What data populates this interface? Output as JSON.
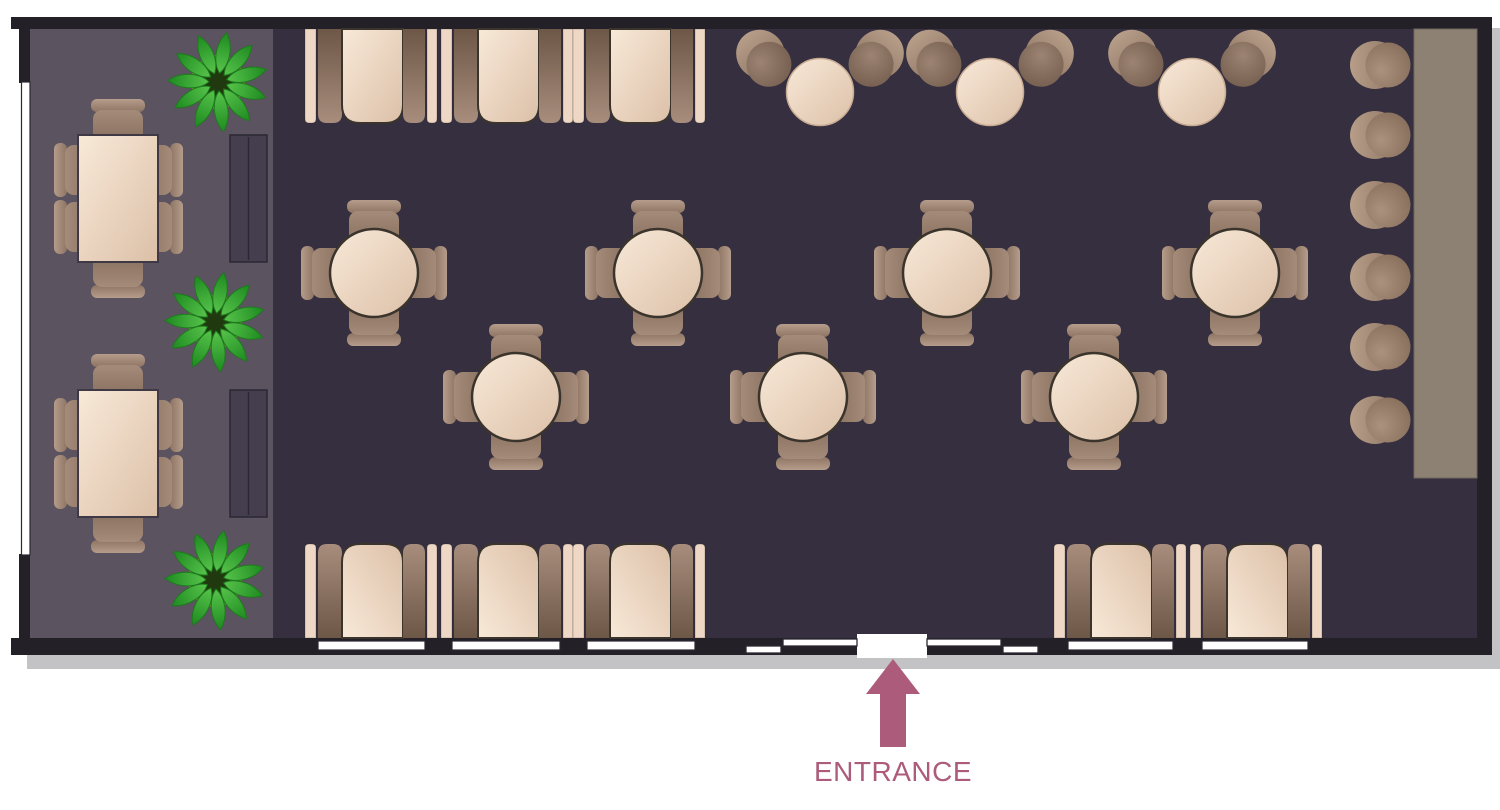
{
  "entranceText": "ENTRANCE",
  "colors": {
    "wall": "#232028",
    "shadow": "rgba(40,35,48,0.28)",
    "floor_main": "#352f3f",
    "floor_left": "#5b5360",
    "cream_1": "#f8e9d8",
    "cream_2": "#dcc0a8",
    "cream_stroke": "#3a342c",
    "rect_stroke": "#3f3945",
    "back_cream": "#eed8c5",
    "bench_1": "#a88d7c",
    "bench_2": "#6d5747",
    "chair_1": "#a58b79",
    "chair_2": "#7c6555",
    "chairback_1": "#b69d8b",
    "chairback_2": "#8d7463",
    "tub_1": "#9c8372",
    "tub_2": "#6f594a",
    "tubback_1": "#b79e89",
    "tubback_2": "#8d7462",
    "stool_1": "#ab917e",
    "stool_2": "#806955",
    "bar": "#8c8173",
    "bar_stroke": "#6f675c",
    "sofa": "#443e4e",
    "sofa_stroke": "#2b2733",
    "leaf_1": "#58c44c",
    "leaf_2": "#1e8a20",
    "leaf_edge": "#1d7a1d",
    "pot_ring": "#8e9027",
    "pot_inner": "#20390f",
    "window_fill": "#ffffff",
    "win_stroke": "#2c2832",
    "entrance": "#ad5b7a"
  },
  "floor_plan": {
    "canvas": {
      "width": 1500,
      "height": 810
    },
    "shadow": [
      21,
      22,
      1477,
      641
    ],
    "walls": [
      [
        11,
        17,
        1481,
        12
      ],
      [
        19,
        17,
        14,
        66
      ],
      [
        19,
        554,
        14,
        101
      ],
      [
        1477,
        17,
        15,
        638
      ],
      [
        11,
        638,
        1481,
        17
      ]
    ],
    "floors": {
      "main": [
        30,
        29,
        1447,
        609
      ],
      "left": [
        30,
        29,
        243,
        609
      ]
    },
    "left_window": [
      21.5,
      82,
      8.5,
      473
    ],
    "bottom_windows": [
      [
        318,
        425
      ],
      [
        452,
        560
      ],
      [
        587,
        695
      ],
      [
        1068,
        1173
      ],
      [
        1202,
        1308
      ]
    ],
    "entrance_opening": [
      857,
      634,
      70,
      24
    ],
    "door_panels": [
      [
        783,
        639,
        74,
        7
      ],
      [
        746,
        646,
        35,
        7
      ],
      [
        927,
        639,
        74,
        7
      ],
      [
        1003,
        646,
        35,
        7
      ]
    ],
    "booth_unit": {
      "w": 132,
      "h": 94,
      "back1": [
        0,
        11
      ],
      "seat1": [
        13,
        24
      ],
      "table": [
        37,
        61
      ],
      "seat2": [
        98,
        22
      ],
      "back2": [
        122,
        10
      ],
      "table_r": 18,
      "seat_r": 9,
      "back_r": 4
    },
    "booths": {
      "top": {
        "y": 29,
        "x": [
          305,
          441,
          573
        ],
        "open": "down"
      },
      "bottom_left": {
        "y": 544,
        "x": [
          305,
          441,
          573
        ],
        "open": "up"
      },
      "bottom_right": {
        "y": 544,
        "x": [
          1054,
          1190
        ],
        "open": "up"
      }
    },
    "round_tables": [
      [
        374,
        273
      ],
      [
        658,
        273
      ],
      [
        947,
        273
      ],
      [
        1235,
        273
      ],
      [
        516,
        397
      ],
      [
        803,
        397
      ],
      [
        1094,
        397
      ]
    ],
    "cafe_sets": {
      "cy": 92,
      "chair_cy": 62,
      "chair_dx": 53,
      "table_r": 33.5,
      "cx": [
        820,
        990,
        1192
      ]
    },
    "rect_tables": {
      "size": [
        80,
        127
      ],
      "pos": [
        [
          78,
          135
        ],
        [
          78,
          390
        ]
      ]
    },
    "sofas": [
      [
        230,
        135,
        37,
        127
      ],
      [
        230,
        390,
        37,
        127
      ]
    ],
    "plants": [
      [
        218,
        82
      ],
      [
        215,
        322
      ],
      [
        215,
        580
      ]
    ],
    "bar": [
      1414,
      29,
      63,
      449
    ],
    "stools": {
      "cx": 1385,
      "cy": [
        65,
        135,
        205,
        277,
        347,
        420
      ]
    },
    "entrance": {
      "label": "ENTRANCE",
      "arrow_points": "893,659 866,694 880,694 880,747 906,747 906,694 920,694",
      "label_x": 893,
      "label_y": 781
    }
  }
}
